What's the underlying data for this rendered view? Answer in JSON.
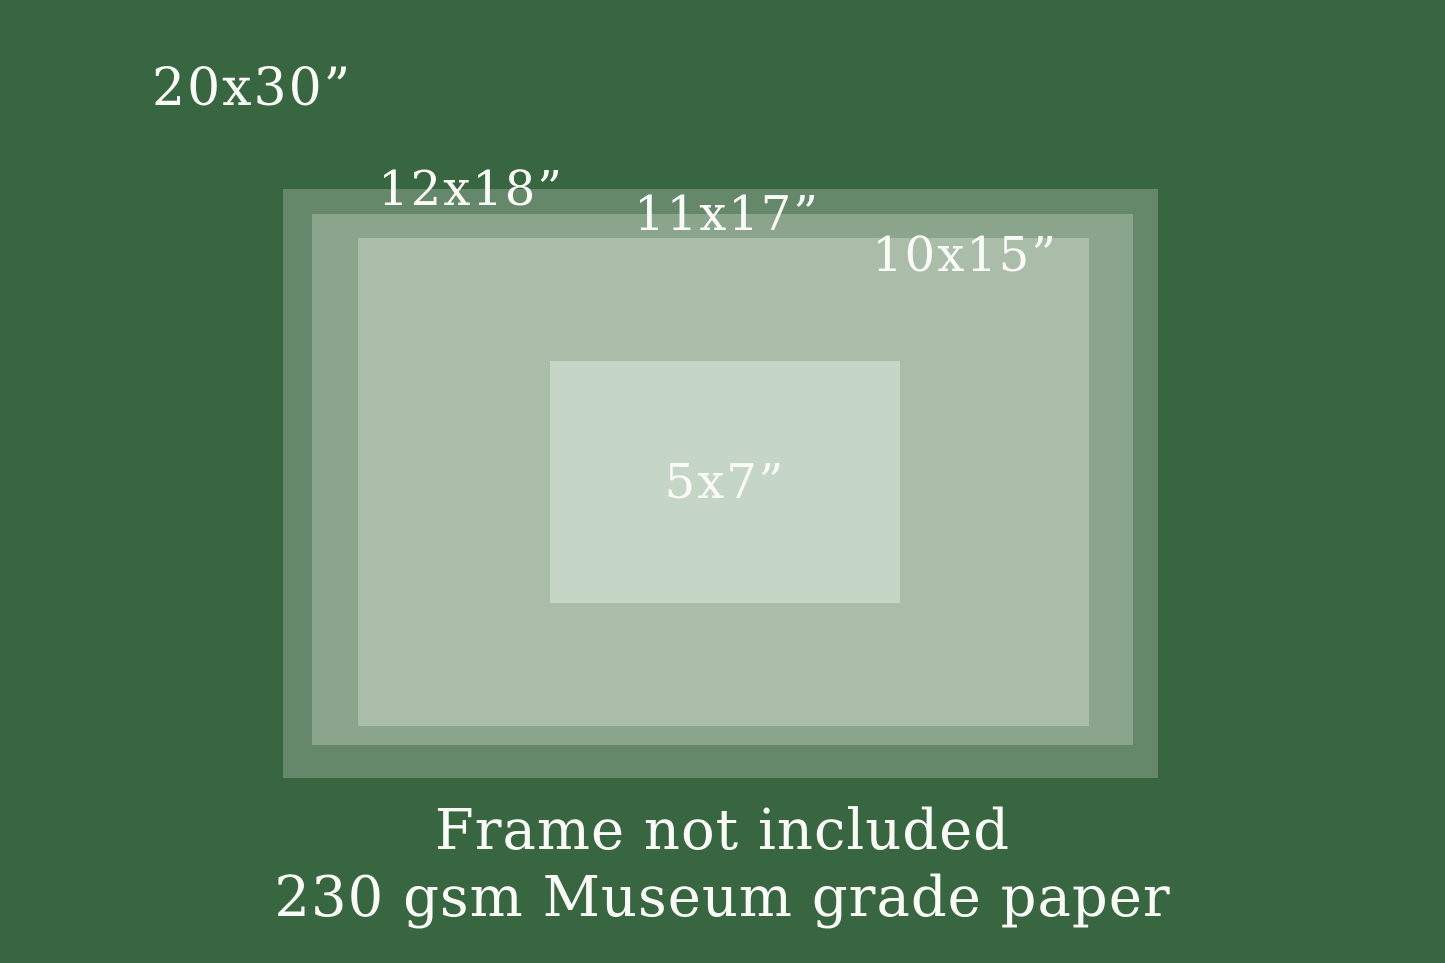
{
  "colors": {
    "background": "#386641",
    "text": "#fafaf6"
  },
  "sizes": [
    {
      "name": "20x30",
      "label": "20x30”",
      "color": "#386641"
    },
    {
      "name": "12x18",
      "label": "12x18”",
      "color": "#648869"
    },
    {
      "name": "11x17",
      "label": "11x17”",
      "color": "#8ba48c"
    },
    {
      "name": "10x15",
      "label": "10x15”",
      "color": "#a9bda9"
    },
    {
      "name": "5x7",
      "label": "5x7”",
      "color": "#c5d5c6"
    }
  ],
  "footer": {
    "line1": "Frame not included",
    "line2": "230 gsm Museum grade paper"
  }
}
